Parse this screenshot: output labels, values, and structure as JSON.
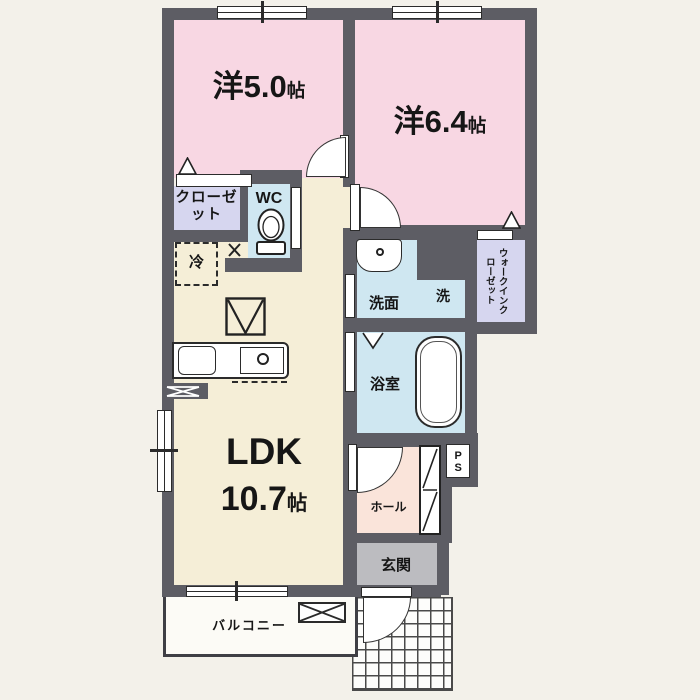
{
  "rooms": {
    "bedroom_5": {
      "label": "洋5.0",
      "unit": "帖"
    },
    "bedroom_6": {
      "label": "洋6.4",
      "unit": "帖"
    },
    "ldk": {
      "label": "LDK",
      "size": "10.7",
      "unit": "帖"
    },
    "closet": {
      "label": "クローゼット"
    },
    "wc": {
      "label": "WC"
    },
    "fridge": {
      "label": "冷"
    },
    "washroom": {
      "label": "洗面"
    },
    "washer": {
      "label": "洗"
    },
    "bathroom": {
      "label": "浴室"
    },
    "walk_in_closet": {
      "label": "ウォークインクローゼット"
    },
    "pipe_space": {
      "label": "PS"
    },
    "hall": {
      "label": "ホール"
    },
    "entrance": {
      "label": "玄関"
    },
    "balcony": {
      "label": "バルコニー"
    }
  },
  "colors": {
    "wall": "#5d5d64",
    "bedroom": "#f8d7e3",
    "ldk": "#f5eed7",
    "wet_area": "#cfe7f1",
    "closet": "#d6d6ef",
    "hall": "#fae4da",
    "entrance_floor": "#bcbcc0",
    "background": "#f3f1ea"
  }
}
